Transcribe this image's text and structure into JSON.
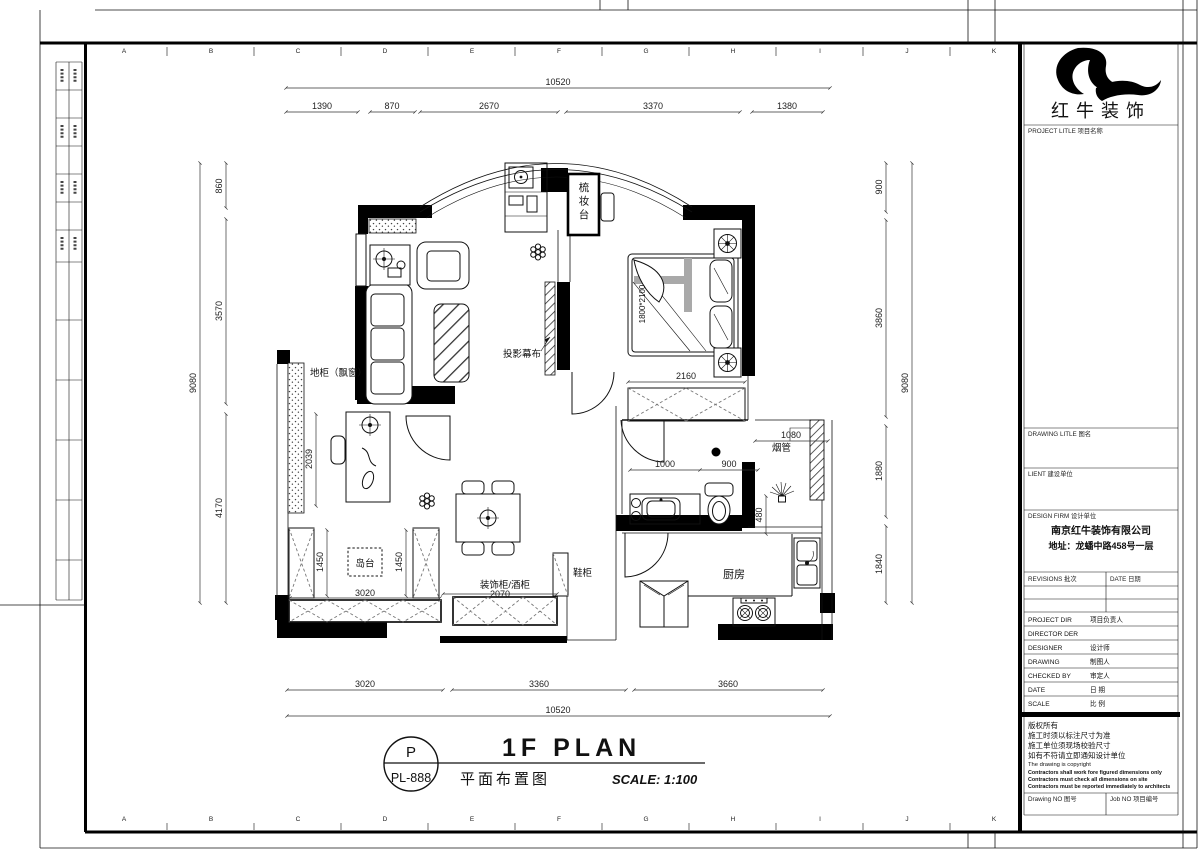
{
  "brand": {
    "logo_text": "红牛装饰"
  },
  "grid_letters": [
    "A",
    "B",
    "C",
    "D",
    "E",
    "F",
    "G",
    "H",
    "I",
    "J",
    "K"
  ],
  "plan_labels": {
    "dressing_table": "梳妆台",
    "projection_screen": "投影幕布",
    "bay_window_cabinet": "地柜（飘窗）",
    "island_counter": "岛台",
    "deco_wine_cabinet": "装饰柜/酒柜",
    "shoe_cabinet": "鞋柜",
    "kitchen": "厨房",
    "flue": "烟管",
    "bed_size": "1800*2100"
  },
  "dims": {
    "top_total": "10520",
    "top_1": "1390",
    "top_2": "870",
    "top_3": "2670",
    "top_4": "3370",
    "top_5": "1380",
    "bot_1": "3020",
    "bot_2": "3360",
    "bot_3": "3660",
    "bot_total": "10520",
    "left_total": "9080",
    "left_1": "860",
    "left_2": "3570",
    "left_3": "4170",
    "right_1": "900",
    "right_2": "3860",
    "right_3": "1880",
    "right_4": "1840",
    "right_total": "9080",
    "bed_w": "2160",
    "wc_a": "1000",
    "wc_b": "900",
    "flue_w": "1080",
    "niche_h": "480",
    "desk_h": "2039",
    "isl_a": "1450",
    "isl_b": "1450",
    "isl_w": "3020",
    "deco_w": "2070"
  },
  "title_bar": {
    "bubble_top": "P",
    "bubble_bottom": "PL-888",
    "title_en": "1F PLAN",
    "title_cn": "平面布置图",
    "scale_text": "SCALE: 1:100"
  },
  "title_block": {
    "project_title": "PROJECT LITLE  项目名称",
    "drawing_title": "DRAWING LITLE  图名",
    "client": "LIENT  建设单位",
    "design_firm": "DESIGN FIRM  设计单位",
    "firm_name": "南京红牛装饰有限公司",
    "firm_address": "地址：龙蟠中路458号一层",
    "revisions": "REVISIONS  批次",
    "revisions_date": "DATE  日期",
    "rows": [
      {
        "en": "PROJECT DIR",
        "cn": "项目负责人"
      },
      {
        "en": "DIRECTOR DER",
        "cn": ""
      },
      {
        "en": "DESIGNER",
        "cn": "设计师"
      },
      {
        "en": "DRAWING",
        "cn": "制图人"
      },
      {
        "en": "CHECKED BY",
        "cn": "审定人"
      },
      {
        "en": "DATE",
        "cn": "日  期"
      },
      {
        "en": "SCALE",
        "cn": "比  例"
      }
    ],
    "cr_cn1": "版权所有",
    "cr_cn2": "施工时须以标注尺寸为准",
    "cr_cn3": "施工单位须现场校验尺寸",
    "cr_cn4": "如有不符请立即通知设计单位",
    "cr_en0": "The drawing is copyright",
    "cr_en1": "Contractors shall work fore figured dimensions only",
    "cr_en2": "Contractors must check all dimensions on site",
    "cr_en3": "Contractors must be reported immediately to architects",
    "drawing_no": "Drawing NO  图号",
    "job_no": "Job NO  项目编号"
  }
}
